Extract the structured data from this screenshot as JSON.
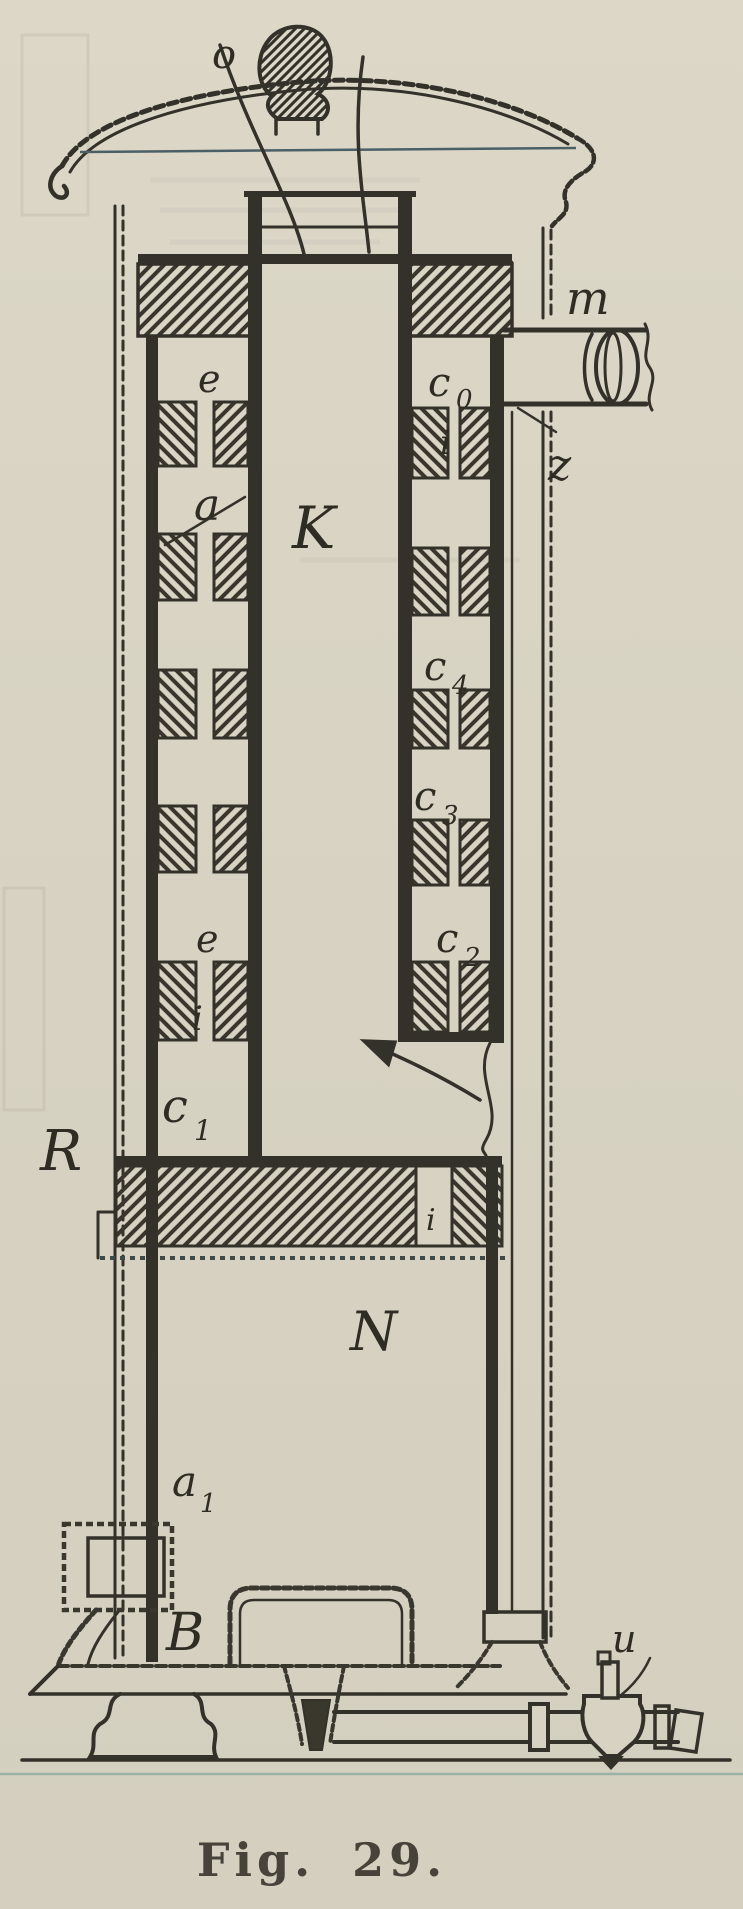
{
  "figure": {
    "caption": "Fig. 29.",
    "type": "engraved cross-section of a vertical apparatus"
  },
  "labels": {
    "o": "o",
    "m": "m",
    "z": "z",
    "e_top": "e",
    "c0": {
      "base": "c",
      "sub": "0"
    },
    "i_right": "i",
    "a": "a",
    "k": "K",
    "c4": {
      "base": "c",
      "sub": "4"
    },
    "c3": {
      "base": "c",
      "sub": "3"
    },
    "c2": {
      "base": "c",
      "sub": "2"
    },
    "e_mid": "e",
    "i_left": "i",
    "c1": {
      "base": "c",
      "sub": "1"
    },
    "r": "R",
    "i_plate": "i",
    "n": "N",
    "a1": {
      "base": "a",
      "sub": "1"
    },
    "b": "B",
    "u": "u"
  },
  "colors": {
    "paper": "#d7d2c2",
    "ink": "#34312a",
    "teal_rule": "#6f9596"
  }
}
